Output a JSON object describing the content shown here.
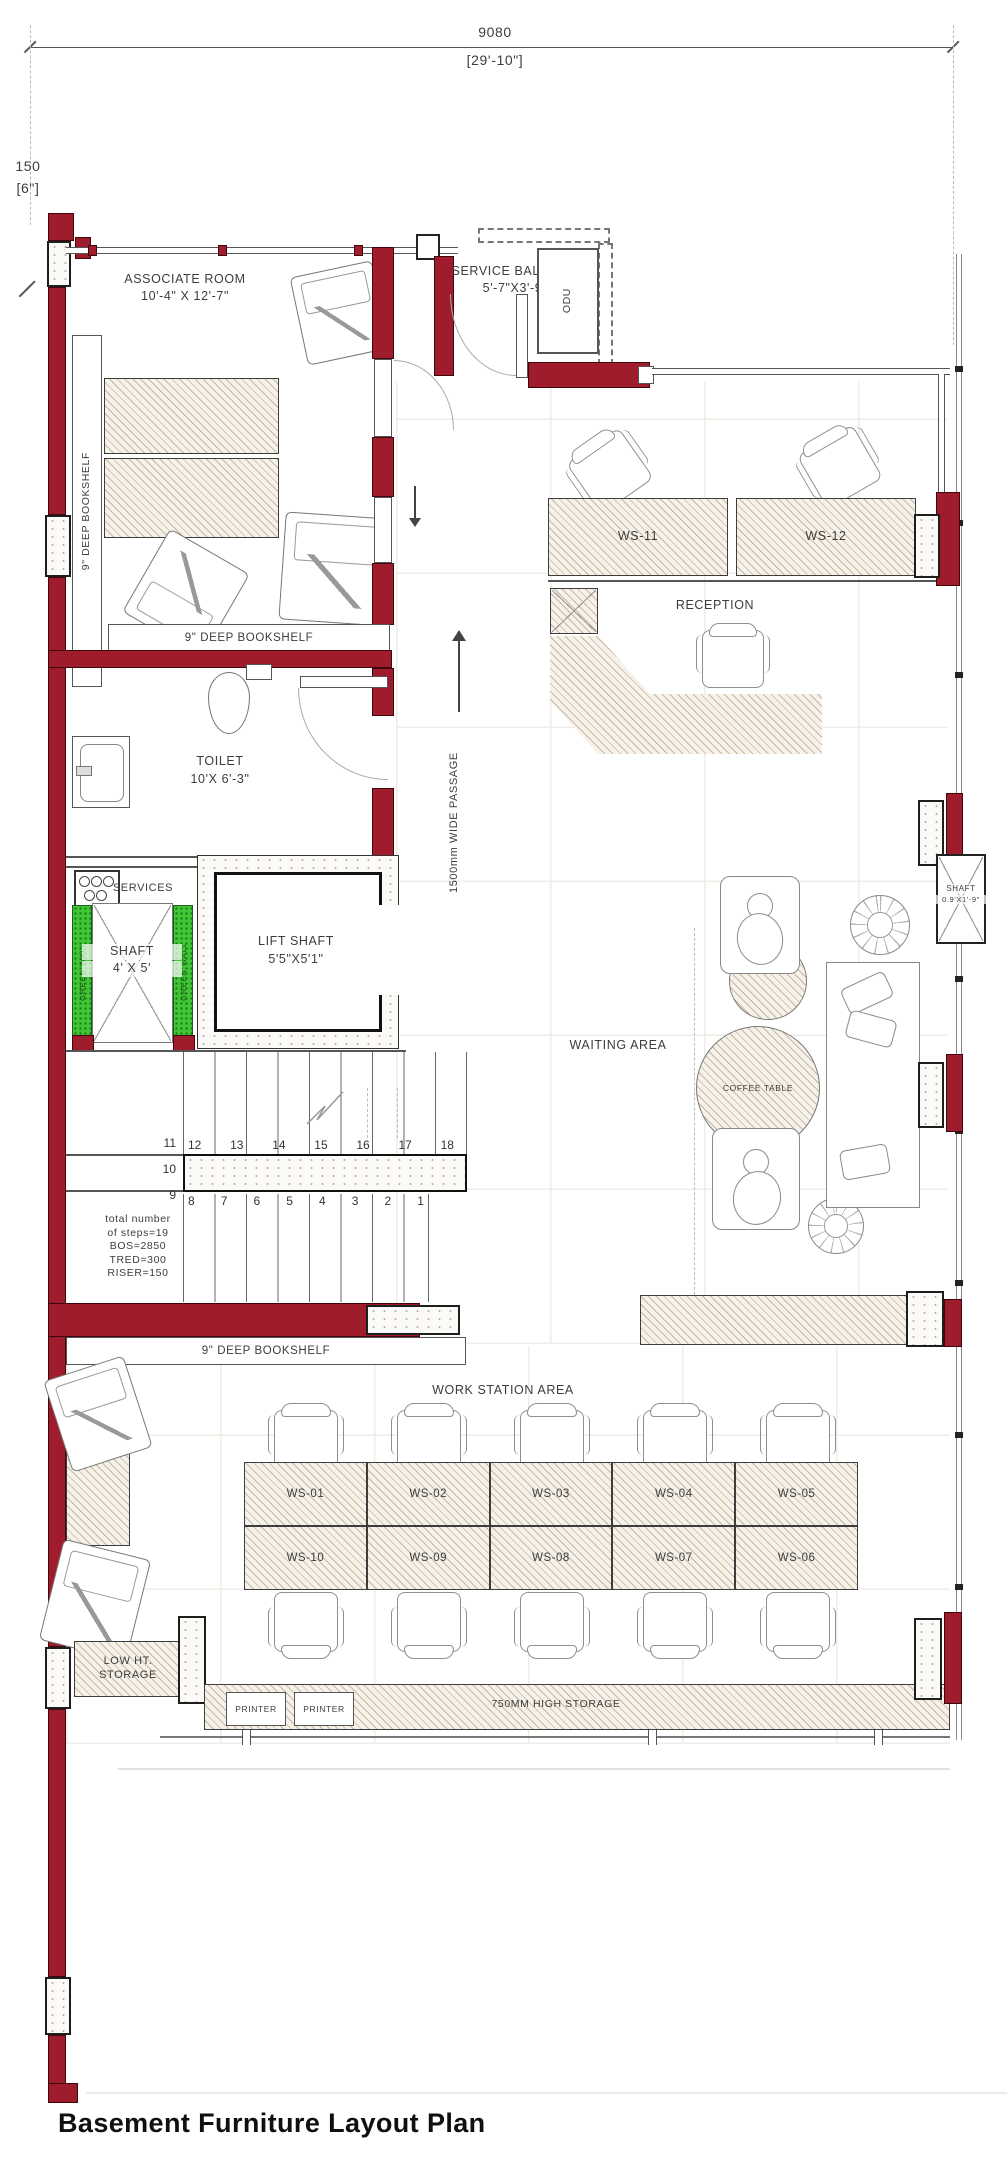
{
  "title": "Basement Furniture Layout Plan",
  "dims": {
    "top_mm": "9080",
    "top_ft": "[29'-10\"]",
    "left_mm": "150",
    "left_ft": "[6\"]"
  },
  "rooms": {
    "associate": {
      "name": "ASSOCIATE ROOM",
      "size": "10'-4\" X 12'-7\""
    },
    "balcony": {
      "name": "SERVICE BALCONY",
      "size": "5'-7\"X3'-9\"",
      "odu": "ODU"
    },
    "toilet": {
      "name": "TOILET",
      "size": "10'X 6'-3\""
    },
    "shaft": {
      "name": "SHAFT",
      "size": "4' X 5'"
    },
    "lift": {
      "name": "LIFT SHAFT",
      "size": "5'5\"X5'1\""
    },
    "rshaft": {
      "name": "SHAFT",
      "size": "0.9'X1'-9\""
    }
  },
  "labels": {
    "services": "SERVICES",
    "greenwall": "GREEN WALL",
    "reception": "RECEPTION",
    "waiting": "WAITING AREA",
    "coffee": "COFFEE TABLE",
    "passage": "1500mm WIDE PASSAGE",
    "bookshelf": "9\" DEEP BOOKSHELF",
    "wsarea": "WORK STATION AREA",
    "low1": "LOW HT.",
    "low2": "STORAGE",
    "printer": "PRINTER",
    "storage750": "750MM HIGH STORAGE"
  },
  "ws": {
    "upper": [
      "WS-11",
      "WS-12"
    ],
    "row1": [
      "WS-01",
      "WS-02",
      "WS-03",
      "WS-04",
      "WS-05"
    ],
    "row2": [
      "WS-10",
      "WS-09",
      "WS-08",
      "WS-07",
      "WS-06"
    ]
  },
  "stairs": {
    "left": [
      "11",
      "10",
      "9"
    ],
    "upper": [
      "12",
      "13",
      "14",
      "15",
      "16",
      "17",
      "18"
    ],
    "lower": [
      "8",
      "7",
      "6",
      "5",
      "4",
      "3",
      "2",
      "1"
    ],
    "note": [
      "total number",
      "of steps=19",
      "BOS=2850",
      "TRED=300",
      "RISER=150"
    ]
  },
  "colors": {
    "wall_red": "#9e1c2b",
    "green": "#41c636",
    "hatch": "#b9a88c"
  }
}
